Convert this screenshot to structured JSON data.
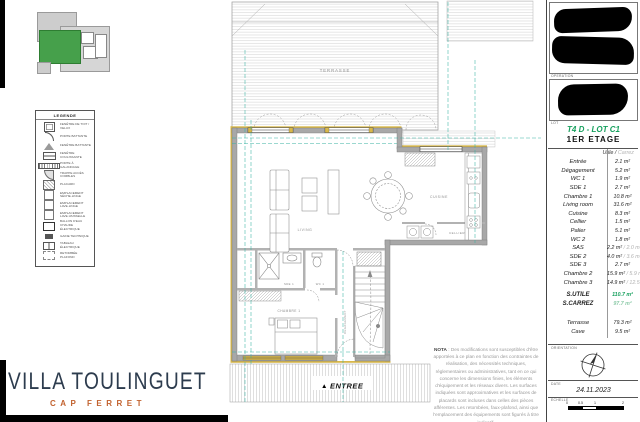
{
  "brand": {
    "title": "VILLA TOULINGUET",
    "subtitle": "CAP FERRET"
  },
  "title_block": {
    "operation_label": "OPERATION",
    "lot_label": "LOT",
    "lot_title": "T4 D - LOT C1",
    "floor_title": "1ER ETAGE",
    "header_utile": "Utile /",
    "header_carrez": "Carrez",
    "table": {
      "rows": [
        {
          "label": "Entrée",
          "utile": "2.1 m²"
        },
        {
          "label": "Dégagement",
          "utile": "5.2 m²"
        },
        {
          "label": "WC 1",
          "utile": "1.9 m²"
        },
        {
          "label": "SDE 1",
          "utile": "2.7 m²"
        },
        {
          "label": "Chambre 1",
          "utile": "10.8 m²"
        },
        {
          "label": "Living room",
          "utile": "31.6 m²"
        },
        {
          "label": "Cuisine",
          "utile": "8.3 m²"
        },
        {
          "label": "Cellier",
          "utile": "1.5 m²"
        },
        {
          "label": "Palier",
          "utile": "5.1 m²"
        },
        {
          "label": "WC 2",
          "utile": "1.8 m²"
        },
        {
          "label": "SAS",
          "utile": "2.2 m²",
          "carrez": "/ 2.0 m²"
        },
        {
          "label": "SDE 2",
          "utile": "4.0 m²",
          "carrez": "/ 3.6 m²"
        },
        {
          "label": "SDE 3",
          "utile": "2.7 m²"
        },
        {
          "label": "Chambre 2",
          "utile": "15.9 m²",
          "carrez": "/ 5.9 m²"
        },
        {
          "label": "Chambre 3",
          "utile": "14.9 m²",
          "carrez": "/ 12.5 m²"
        }
      ],
      "totals": [
        {
          "label": "S.UTILE",
          "value": "110.7 m²"
        },
        {
          "label": "S.CARREZ",
          "value": "97.7 m²"
        }
      ],
      "extras": [
        {
          "label": "Terrasse",
          "value": "79.3 m²"
        },
        {
          "label": "Cave",
          "value": "9.5 m²"
        }
      ]
    },
    "orientation_label": "ORIENTATION",
    "date_label": "DATE",
    "date_value": "24.11.2023",
    "scale_label": "ECHELLE",
    "scale_ticks": [
      "0",
      "0.5",
      "1",
      "2"
    ]
  },
  "legend": {
    "title": "LEGENDE",
    "items": [
      {
        "icon": "roof-window-icon",
        "label": "Fenêtre de toit / velux"
      },
      {
        "icon": "swing-door-icon",
        "label": "Porte battante"
      },
      {
        "icon": "casement-window-icon",
        "label": "Fenêtre battante"
      },
      {
        "icon": "sliding-window-icon",
        "label": "Fenêtre coulissante"
      },
      {
        "icon": "pocket-door-icon",
        "label": "Porte à galandage"
      },
      {
        "icon": "hatch-access-icon",
        "label": "Trappe accès combles"
      },
      {
        "icon": "closet-icon",
        "label": "Placard"
      },
      {
        "icon": "dryer-icon",
        "label": "Emplacement sèche-linge"
      },
      {
        "icon": "washer-icon",
        "label": "Emplacement lave-linge"
      },
      {
        "icon": "dishwasher-icon",
        "label": "Emplacement lave-vaisselle"
      },
      {
        "icon": "water-heater-icon",
        "label": "Ballon d'eau chaude électrique"
      },
      {
        "icon": "technical-duct-icon",
        "label": "Gaine technique"
      },
      {
        "icon": "electric-panel-icon",
        "label": "Tableau électrique"
      },
      {
        "icon": "ceiling-drop-icon",
        "label": "Retombée plafond"
      }
    ]
  },
  "plan": {
    "labels": {
      "terrasse": "TERRASSE",
      "living": "LIVING",
      "cuisine": "CUISINE",
      "cellier": "CELLIER",
      "sde1": "SDE 1",
      "wc1": "WC 1",
      "chambre1": "CHAMBRE 1",
      "degagement": "DEGAGEMENT",
      "entree_arrow": "▲",
      "entree": "ENTREE"
    },
    "nota_label": "NOTA",
    "nota_text": " : Des modifications sont susceptibles d'être apportées à ce plan en fonction des contraintes de réalisation, des nécessités techniques, réglementaires ou administratives, tant en ce qui concerne les dimensions finies, les éléments d'équipement et les réseaux divers. Les surfaces indiquées sont approximatives et les surfaces de placards sont incluses dans celles des pièces afférentes. Les retombées, faux-plafond, ainsi que l'emplacement des équipements sont figurés à titre indicatif."
  },
  "colors": {
    "accent_green": "#17a05e",
    "light_green": "#8fcbaa",
    "brand_navy": "#2d3c4e",
    "brand_orange": "#c2622f",
    "dimension_teal": "#38b2a2",
    "wood_yellow": "#d8b84a",
    "wall_gray": "#a8a8a8"
  }
}
